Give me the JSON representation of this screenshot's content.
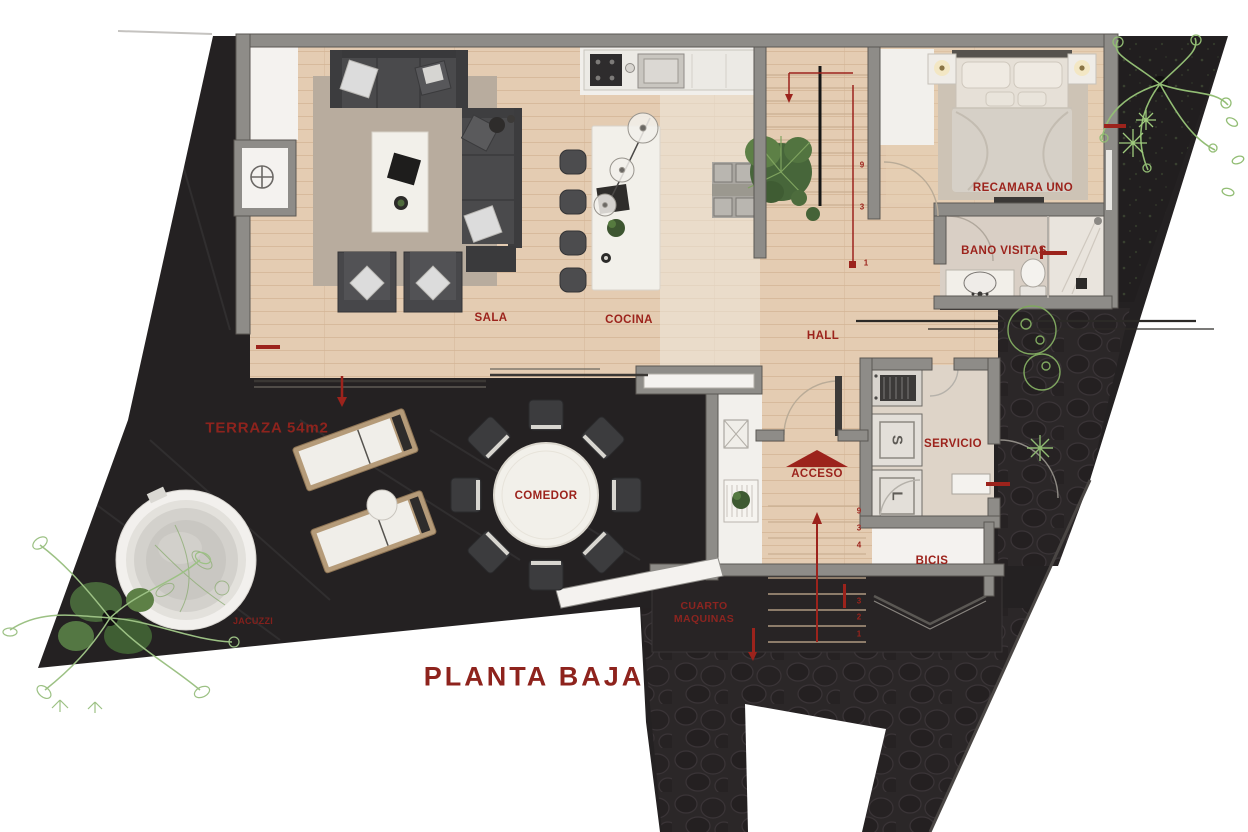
{
  "plan": {
    "title": "PLANTA BAJA",
    "rooms": {
      "sala": "SALA",
      "cocina": "COCINA",
      "hall": "HALL",
      "recamara_uno": "RECAMARA UNO",
      "bano_visitas": "BANO VISITAS",
      "servicio": "SERVICIO",
      "acceso": "ACCESO",
      "comedor": "COMEDOR",
      "terraza": "TERRAZA 54m2",
      "jacuzzi": "JACUZZI",
      "cuarto_maquinas_line1": "CUARTO",
      "cuarto_maquinas_line2": "MAQUINAS",
      "bicis": "BICIS"
    },
    "appliances": {
      "secadora_letter": "S",
      "lavadora_letter": "L"
    },
    "stairs": {
      "entry_steps": [
        "9",
        "3",
        "4",
        "3",
        "2",
        "1"
      ],
      "main_steps": [
        "9",
        "3",
        "1"
      ]
    },
    "colors": {
      "label_red": "#9c231c",
      "site_dark": "#242122",
      "wood": "#e4cdb3",
      "wall_gray": "#8e8c88"
    }
  }
}
